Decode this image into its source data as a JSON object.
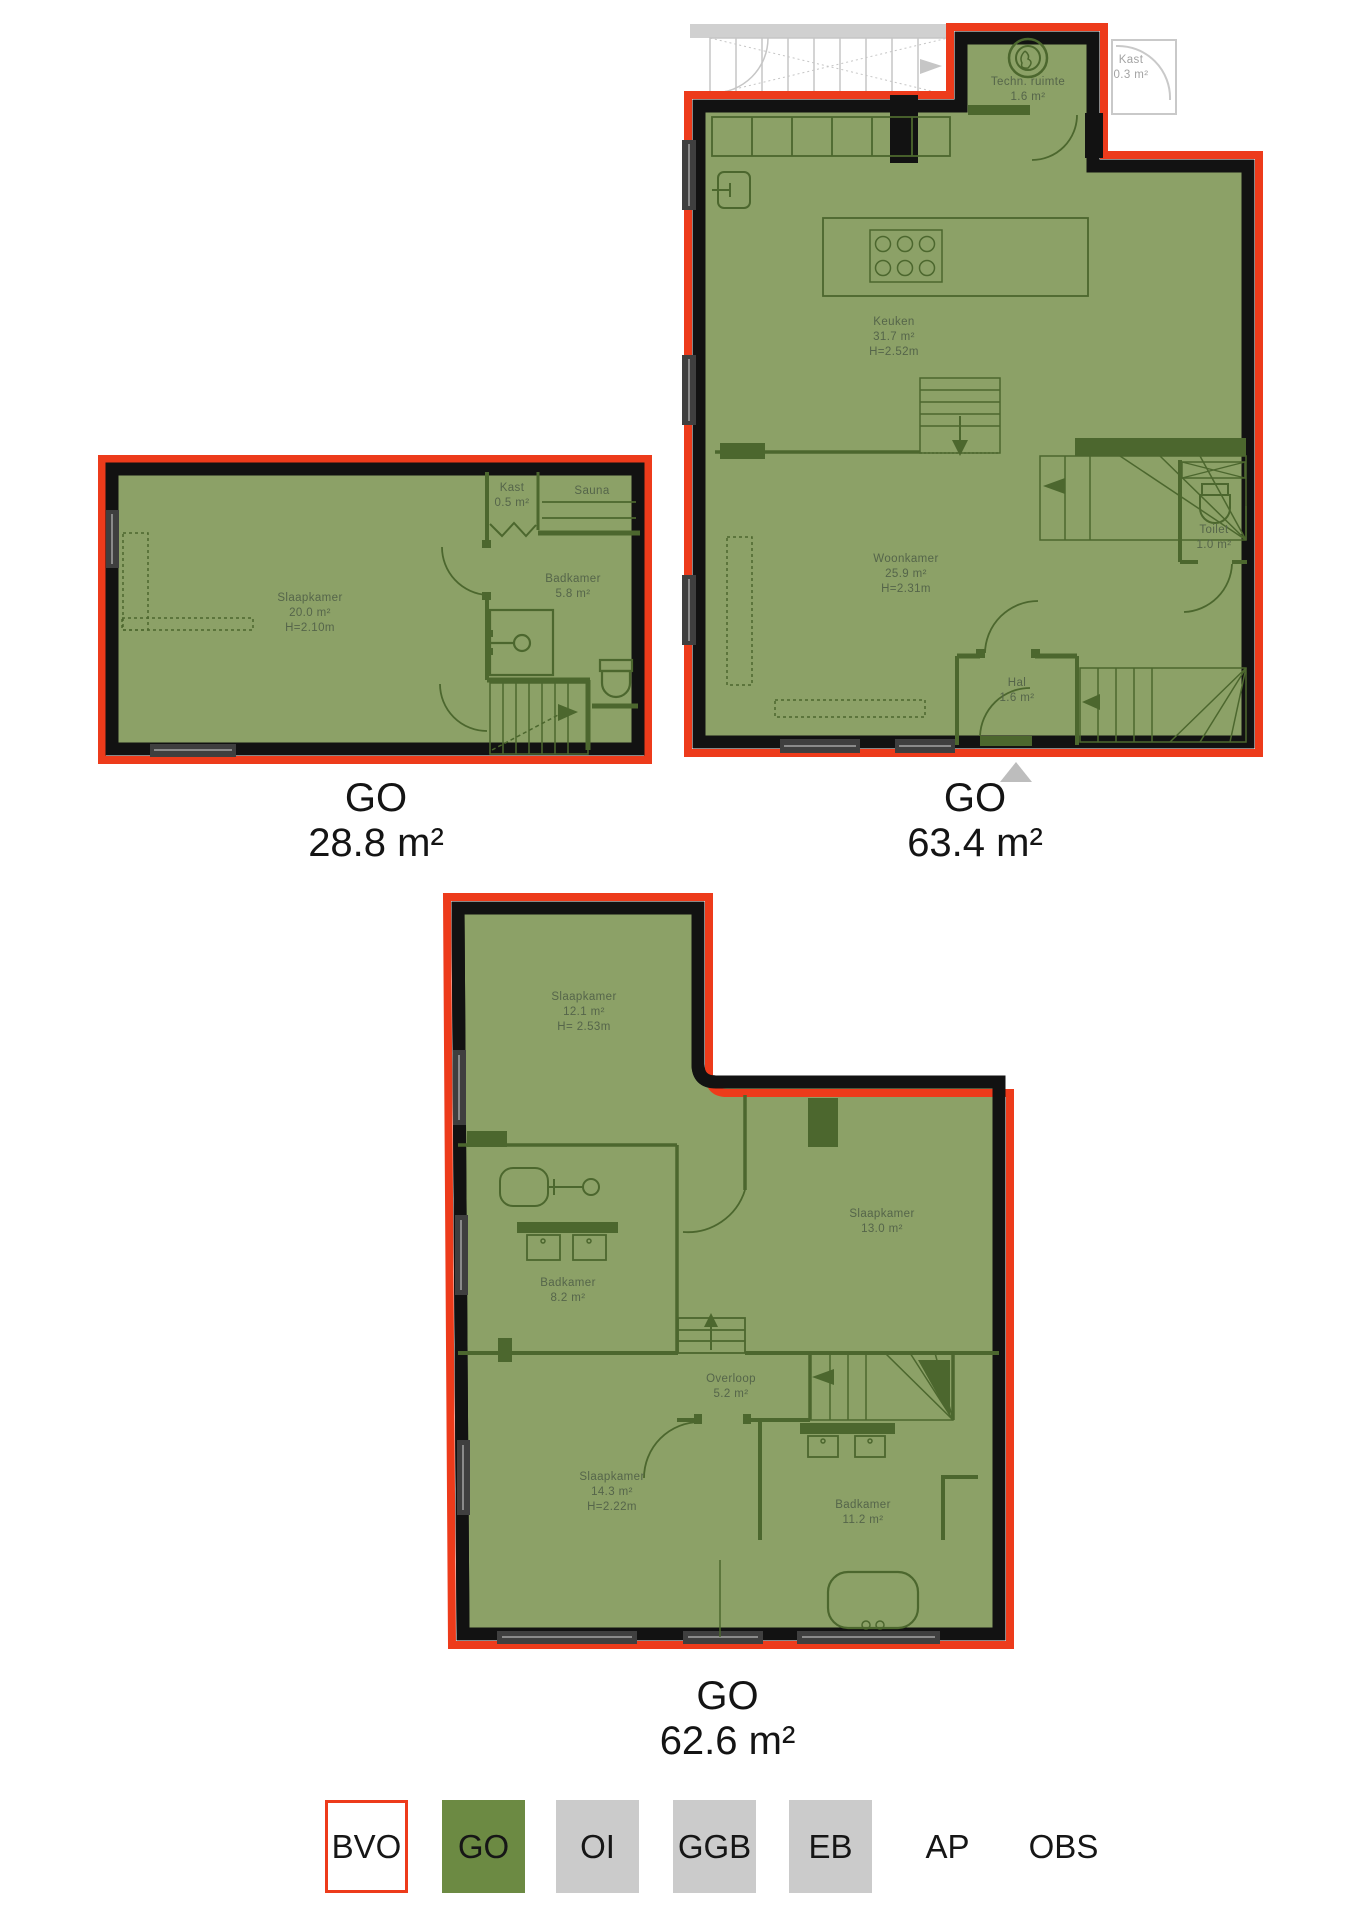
{
  "colors": {
    "go_fill": "#8CA167",
    "bvo_outline": "#ED3B1B",
    "exterior_wall": "#121212",
    "interior_line": "#4C672E",
    "outside_grey": "#C6C6C6",
    "legend_grey": "#CBCBCB",
    "legend_green": "#6C8A43",
    "label_text": "#55654a",
    "caption_text": "#141414"
  },
  "plans": [
    {
      "caption_label": "GO",
      "caption_area": "28.8 m²",
      "rooms": {
        "slaapkamer": {
          "name": "Slaapkamer",
          "area": "20.0 m²",
          "height": "H=2.10m"
        },
        "kast": {
          "name": "Kast",
          "area": "0.5 m²"
        },
        "sauna": {
          "name": "Sauna"
        },
        "badkamer": {
          "name": "Badkamer",
          "area": "5.8 m²"
        }
      }
    },
    {
      "caption_label": "GO",
      "caption_area": "63.4 m²",
      "rooms": {
        "techn_ruimte": {
          "name": "Techn. ruimte",
          "area": "1.6 m²"
        },
        "kast_buiten": {
          "name": "Kast",
          "area": "0.3 m²"
        },
        "keuken": {
          "name": "Keuken",
          "area": "31.7 m²",
          "height": "H=2.52m"
        },
        "woonkamer": {
          "name": "Woonkamer",
          "area": "25.9 m²",
          "height": "H=2.31m"
        },
        "toilet": {
          "name": "Toilet",
          "area": "1.0 m²"
        },
        "hal": {
          "name": "Hal",
          "area": "1.6 m²"
        }
      }
    },
    {
      "caption_label": "GO",
      "caption_area": "62.6 m²",
      "rooms": {
        "slaapkamer1": {
          "name": "Slaapkamer",
          "area": "12.1 m²",
          "height": "H= 2.53m"
        },
        "slaapkamer2": {
          "name": "Slaapkamer",
          "area": "13.0 m²"
        },
        "badkamer1": {
          "name": "Badkamer",
          "area": "8.2 m²"
        },
        "overloop": {
          "name": "Overloop",
          "area": "5.2 m²"
        },
        "slaapkamer3": {
          "name": "Slaapkamer",
          "area": "14.3 m²",
          "height": "H=2.22m"
        },
        "badkamer2": {
          "name": "Badkamer",
          "area": "11.2 m²"
        }
      }
    }
  ],
  "legend": {
    "items": [
      {
        "label": "BVO"
      },
      {
        "label": "GO"
      },
      {
        "label": "OI"
      },
      {
        "label": "GGB"
      },
      {
        "label": "EB"
      },
      {
        "label": "AP"
      },
      {
        "label": "OBS"
      }
    ]
  }
}
